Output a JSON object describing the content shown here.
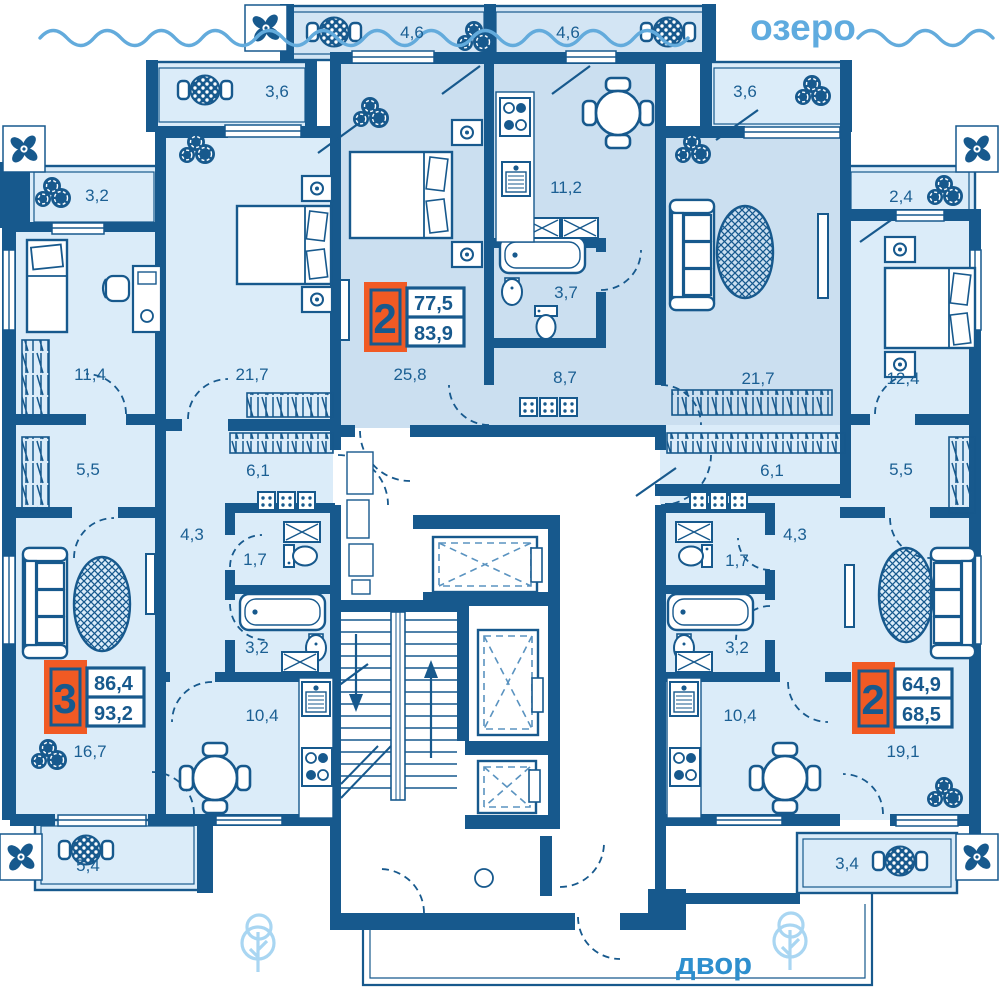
{
  "context": {
    "lake": "озеро",
    "yard": "двор"
  },
  "apartments": {
    "left": {
      "rooms": "3",
      "living_area": "86,4",
      "total_area": "93,2"
    },
    "center": {
      "rooms": "2",
      "living_area": "77,5",
      "total_area": "83,9"
    },
    "right": {
      "rooms": "2",
      "living_area": "64,9",
      "total_area": "68,5"
    }
  },
  "rooms": {
    "balc_32_left": "3,2",
    "balc_36_left": "3,6",
    "balc_46_left": "4,6",
    "balc_46_right": "4,6",
    "balc_36_right": "3,6",
    "balc_24_right": "2,4",
    "bed_114": "11,4",
    "room_217_left": "21,7",
    "bed_258": "25,8",
    "kitchen_112": "11,2",
    "bath_37": "3,7",
    "hall_87": "8,7",
    "living_217_right": "21,7",
    "bed_124": "12,4",
    "corr_55_left": "5,5",
    "corr_61_left": "6,1",
    "corr_61_right": "6,1",
    "corr_55_right": "5,5",
    "hall_43_left": "4,3",
    "hall_43_right": "4,3",
    "wc_17_left": "1,7",
    "wc_17_right": "1,7",
    "bath_32_left": "3,2",
    "bath_32_right": "3,2",
    "kitchen_104_left": "10,4",
    "kitchen_104_right": "10,4",
    "living_167": "16,7",
    "living_191": "19,1",
    "balc_54": "5,4",
    "balc_34": "3,4"
  },
  "colors": {
    "wall": "#17598d",
    "room": "#dbecf9",
    "room_center": "#cbdff0",
    "accent_badge": "#f15a24",
    "water": "#63abdc",
    "tree": "#a9d6f2",
    "yard_text": "#2e8fce"
  }
}
